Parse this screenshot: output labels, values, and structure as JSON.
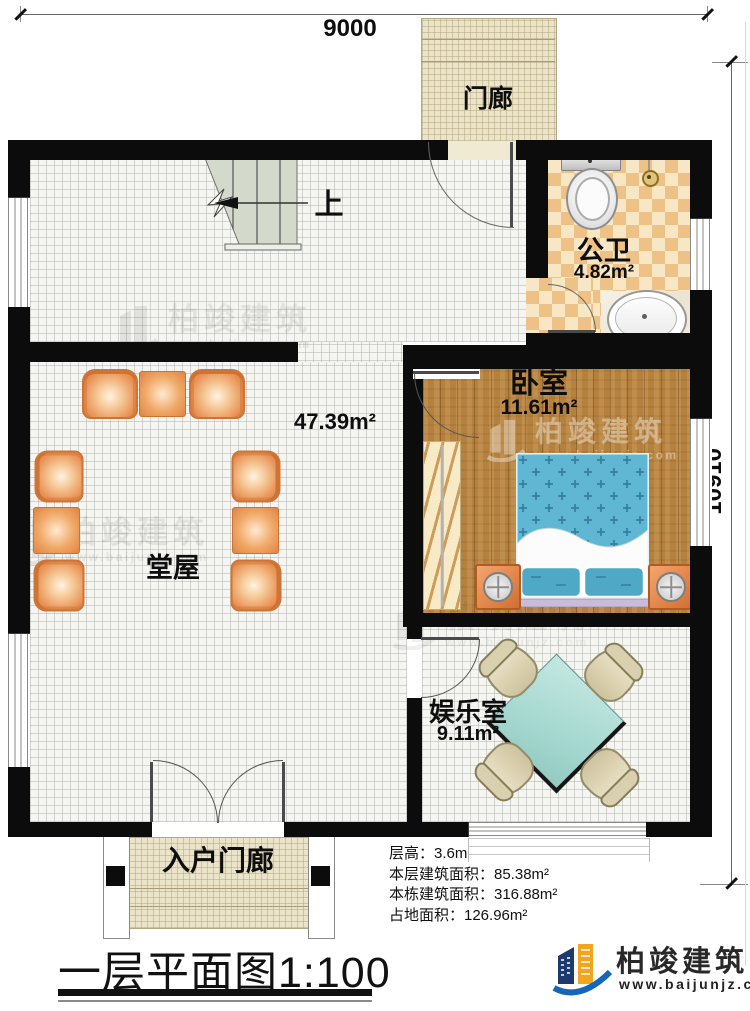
{
  "dimensions": {
    "top": "9000",
    "right": "10910"
  },
  "rooms": {
    "porch_top": {
      "label": "门廊"
    },
    "bathroom": {
      "label": "公卫",
      "area": "4.82m²"
    },
    "hall": {
      "label": "堂屋",
      "area": "47.39m²"
    },
    "bedroom": {
      "label": "卧室",
      "area": "11.61m²"
    },
    "entertainment": {
      "label": "娱乐室",
      "area": "9.11m²"
    },
    "entry_porch": {
      "label": "入户门廊"
    },
    "stairs": {
      "up_label": "上"
    }
  },
  "info": {
    "lines": [
      "层高：3.6m",
      "本层建筑面积：85.38m²",
      "本栋建筑面积：316.88m²",
      "占地面积：126.96m²"
    ]
  },
  "title": "一层平面图1:100",
  "logo": {
    "brand": "柏竣建筑",
    "url": "www.baijunjz.com"
  },
  "watermark": {
    "brand": "柏竣建筑",
    "url": "www.baijunjz.com"
  },
  "colors": {
    "wall": "#0c0c0c",
    "wood_floor": "#b5813e",
    "checker_tile_dark": "#eec186",
    "checker_tile_light": "#f8e7c4",
    "porch_tile": "#ebe4c9",
    "bed_blue": "#5fb7d3",
    "table_teal": "#abdcd5",
    "furniture_orange": "#e8955a",
    "logo_navy": "#1c3a6d",
    "logo_orange": "#f2a51f",
    "logo_blue": "#1467b8"
  }
}
